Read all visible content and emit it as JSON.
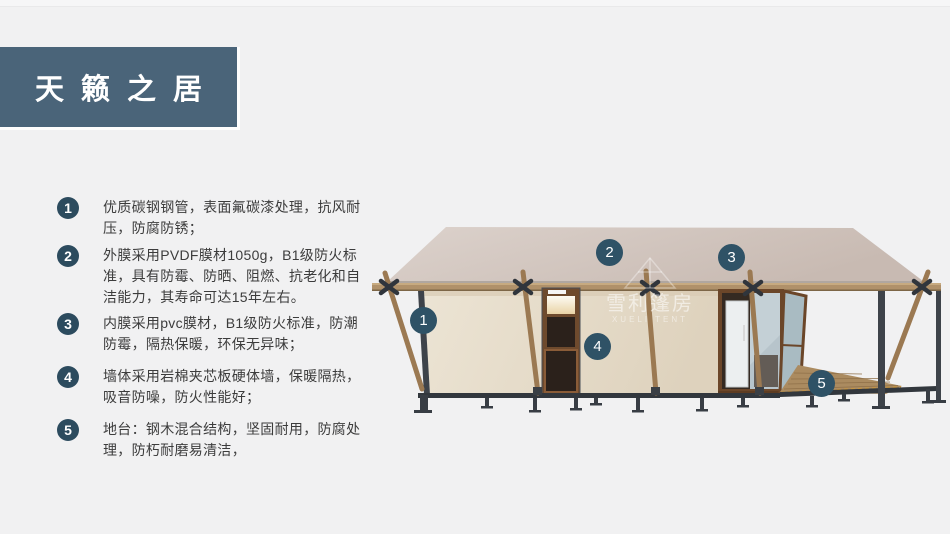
{
  "page": {
    "background_color": "#f1f1f2"
  },
  "header": {
    "title": "天籁之居",
    "bg_color": "#4a6479",
    "text_color": "#ffffff"
  },
  "features": [
    {
      "num": "1",
      "text": "优质碳钢钢管，表面氟碳漆处理，抗风耐压，防腐防锈；"
    },
    {
      "num": "2",
      "text": "外膜采用PVDF膜材1050g，B1级防火标准，具有防霉、防晒、阻燃、抗老化和自洁能力，其寿命可达15年左右。"
    },
    {
      "num": "3",
      "text": "内膜采用pvc膜材，B1级防火标准，防潮防霉，隔热保暖，环保无异味；"
    },
    {
      "num": "4",
      "text": "墙体采用岩棉夹芯板硬体墙，保暖隔热，吸音防噪，防火性能好；"
    },
    {
      "num": "5",
      "text": "地台：钢木混合结构，坚固耐用，防腐处理，防朽耐磨易清洁，"
    }
  ],
  "diagram": {
    "description": "3D render of glamping tent cabin with numbered part callouts",
    "callouts": [
      {
        "num": "1"
      },
      {
        "num": "2"
      },
      {
        "num": "3"
      },
      {
        "num": "4"
      },
      {
        "num": "5"
      }
    ],
    "watermark": {
      "cn": "雪利篷房",
      "en": "XUELI TENT"
    },
    "palette": {
      "callout_badge": "#2f5266",
      "list_badge": "#2c4b5e",
      "roof": "#cfc3bc",
      "wall": "#e9e0cf",
      "wood_beam": "#b0916a",
      "pole": "#9b7952",
      "steel": "#3b4047",
      "door_frame": "#6b4629",
      "deck": "#ab8b60"
    }
  }
}
